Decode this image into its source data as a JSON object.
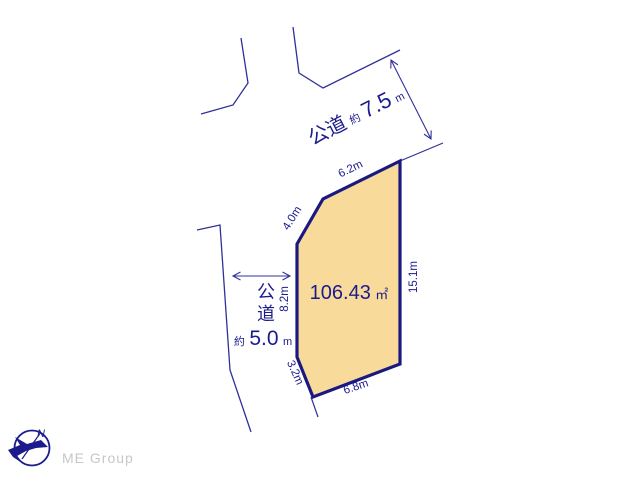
{
  "diagram": {
    "background_color": "#ffffff",
    "line_color": "#30309a",
    "text_color": "#1b1b8e",
    "parcel": {
      "fill_color": "#F8DA9B",
      "border_color": "#191980",
      "area_value": "106.43",
      "area_unit": "㎡",
      "side_labels": {
        "top": "6.2m",
        "upper_left": "4.0m",
        "left": "8.2m",
        "lower_left": "3.2m",
        "bottom": "6.8m",
        "right": "15.1m"
      }
    },
    "roads": {
      "top": {
        "name": "公道",
        "approx": "約",
        "width_value": "7.5",
        "unit": "m"
      },
      "left": {
        "name_char1": "公",
        "name_char2": "道",
        "approx": "約",
        "width_value": "5.0",
        "unit": "m"
      }
    },
    "compass": {
      "north_label": "N"
    },
    "brand": {
      "logo_text": "ME Group",
      "color": "#c7c7c7"
    }
  }
}
